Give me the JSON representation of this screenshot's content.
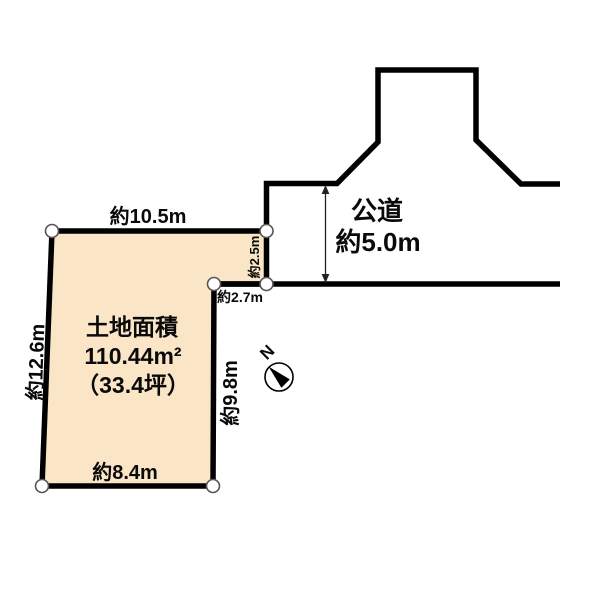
{
  "diagram": {
    "parcel": {
      "area_title": "土地面積",
      "area_m2": "110.44m²",
      "area_tsubo": "（33.4坪）",
      "fill_color": "#fae6c6",
      "dimensions": {
        "top": "約10.5m",
        "left": "約12.6m",
        "bottom": "約8.4m",
        "right": "約9.8m",
        "right_upper": "約2.5m",
        "step": "約2.7m"
      }
    },
    "road": {
      "label": "公道",
      "width_label": "約5.0m"
    },
    "compass": {
      "label": "N"
    },
    "line_color": "#000000"
  }
}
